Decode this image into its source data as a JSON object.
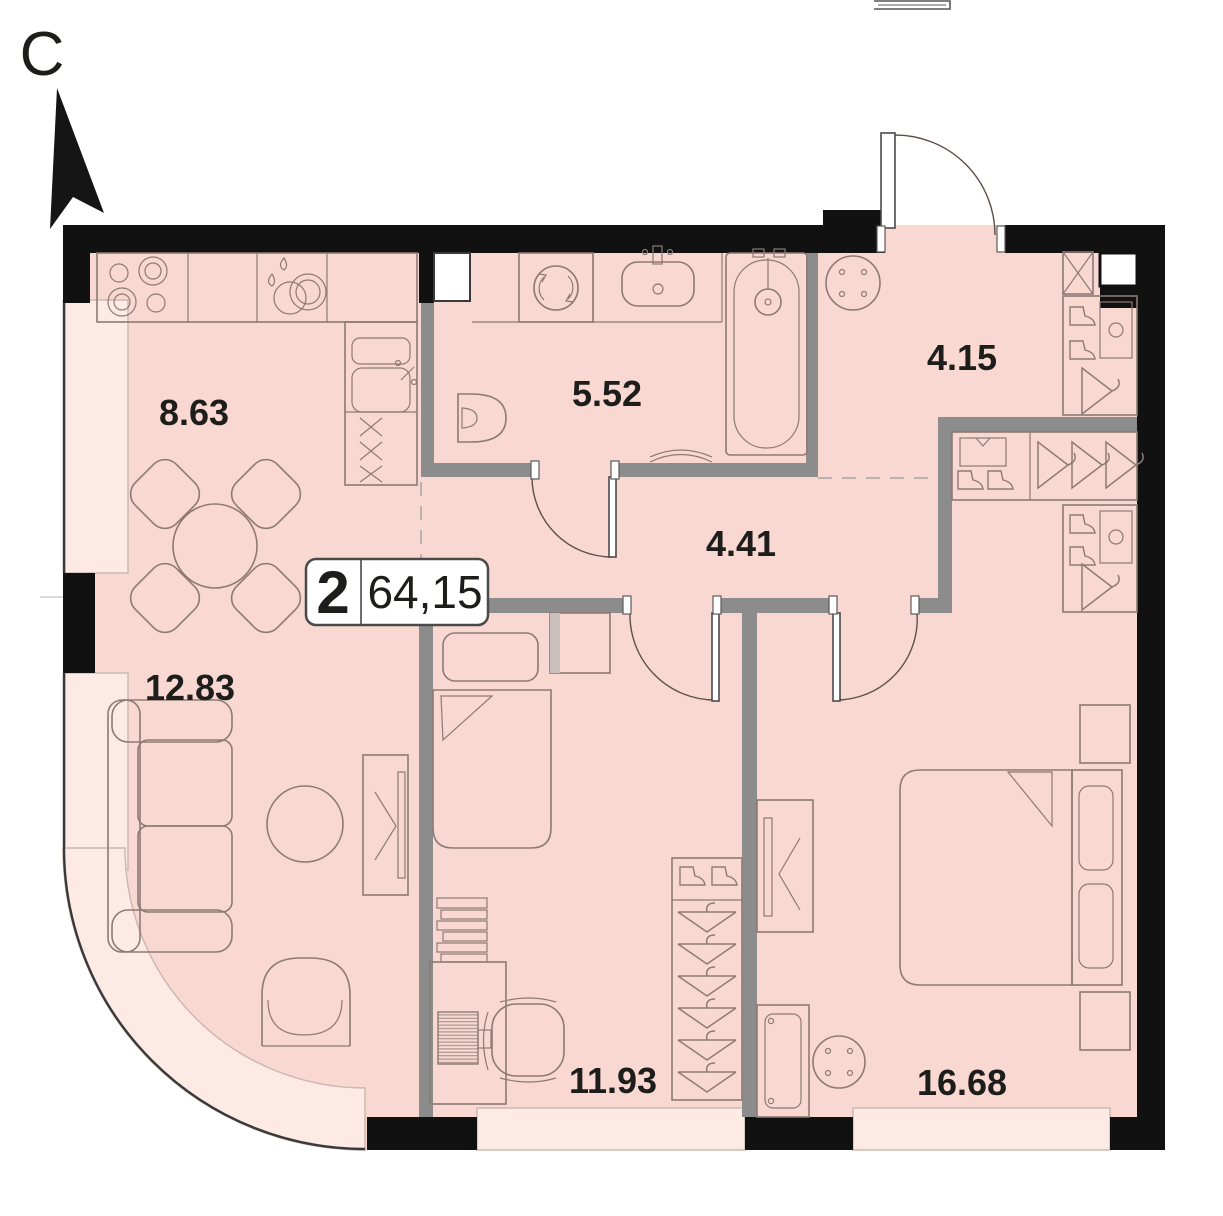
{
  "title": "Apartment floor plan",
  "north_indicator": {
    "letter": "С"
  },
  "apartment_badge": {
    "room_count": "2",
    "total_area": "64,15"
  },
  "room_areas": {
    "kitchen": "8.63",
    "bathroom": "5.52",
    "entry_hall": "4.15",
    "corridor": "4.41",
    "living_room": "12.83",
    "bedroom_small": "11.93",
    "bedroom_master": "16.68"
  },
  "colors": {
    "floor_fill": "#f8d8d1",
    "glazing_fill": "#fdeae5",
    "exterior_wall": "#111111",
    "partition_wall": "#8c8c8c",
    "furniture_line": "#8d7a73",
    "label_text": "#1d1d1b"
  }
}
